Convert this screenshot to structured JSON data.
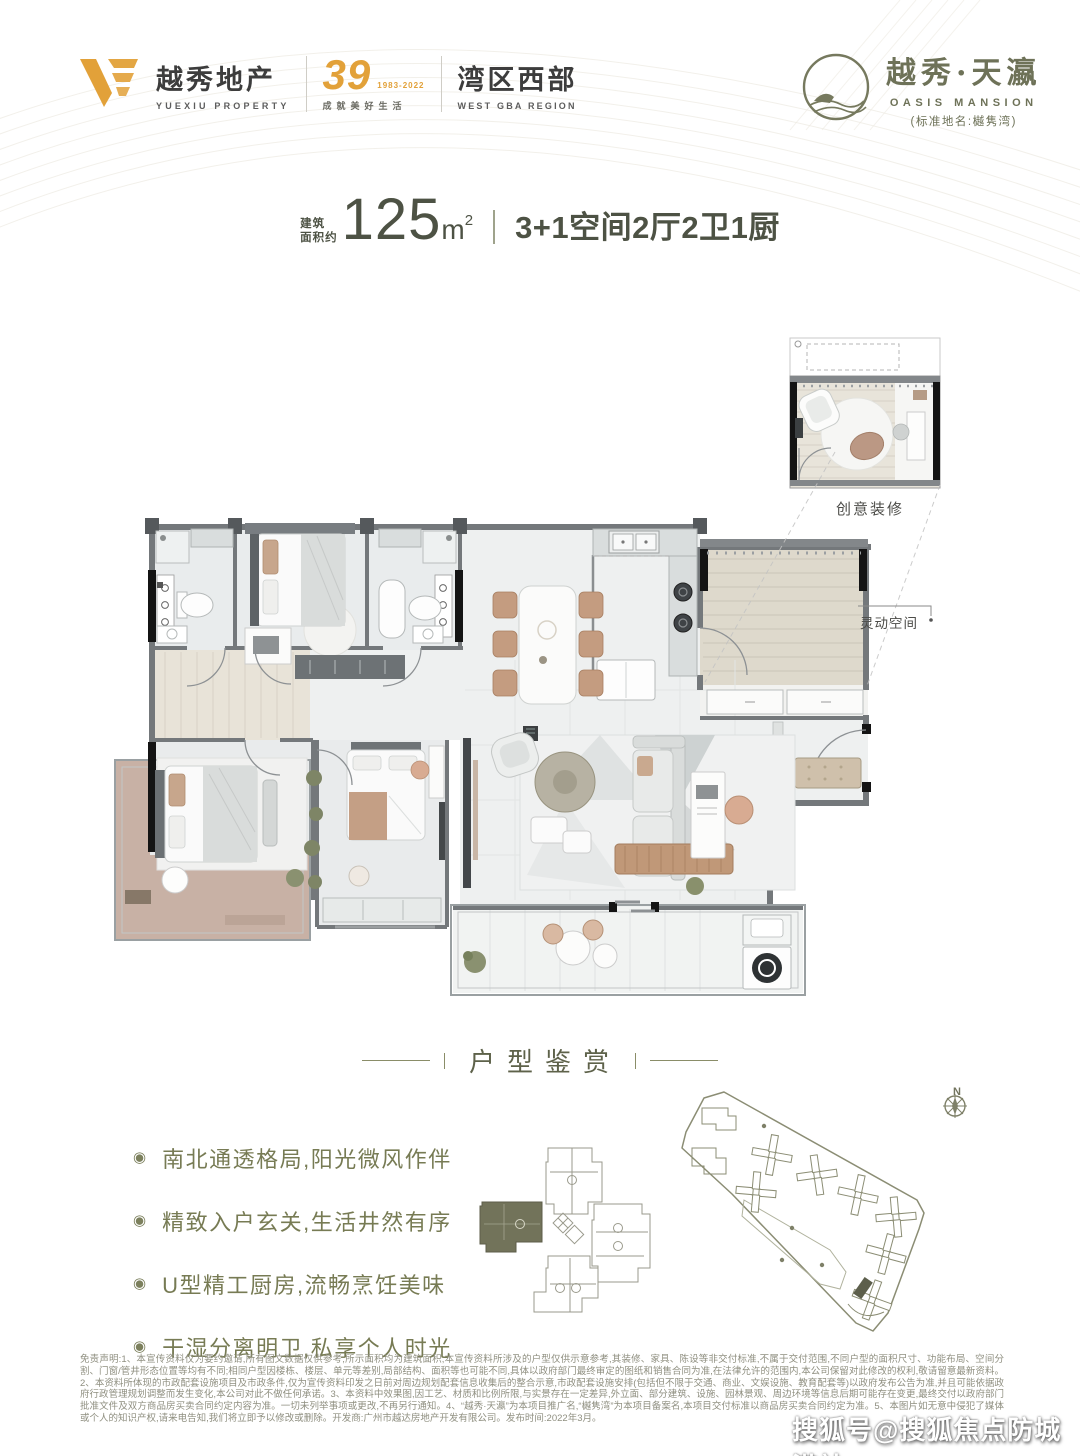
{
  "brand": {
    "yuexiu": {
      "cn": "越秀地产",
      "en": "YUEXIU PROPERTY"
    },
    "anniversary": {
      "number": "39",
      "years": "1983-2022",
      "slogan": "成就美好生活"
    },
    "region": {
      "cn": "湾区西部",
      "en": "WEST GBA REGION"
    },
    "project": {
      "cn": "越秀·天瀛",
      "en": "OASIS MANSION",
      "standard_name": "(标准地名:樾隽湾)"
    }
  },
  "headline": {
    "area_label_l1": "建筑",
    "area_label_l2": "面积约",
    "area_value": "125",
    "area_unit": "m",
    "area_sup": "2",
    "spec": "3+1空间2厅2卫1厨"
  },
  "floorplan": {
    "inset_caption": "创意装修",
    "flex_space_label": "灵动空间"
  },
  "section_title": "户型鉴赏",
  "features": [
    "南北通透格局,阳光微风作伴",
    "精致入户玄关,生活井然有序",
    "U型精工厨房,流畅烹饪美味",
    "干湿分离明卫,私享个人时光"
  ],
  "site": {
    "compass": "N"
  },
  "disclaimer": "免责声明:1、本宣传资料仅为要约邀请,所有图文数据仅供参考,所示面积均为建筑面积,本宣传资料所涉及的户型仅供示意参考,其装修、家具、陈设等非交付标准,不属于交付范围,不同户型的面积尺寸、功能布局、空间分割、门窗/管井形态位置等均有不同;相同户型因楼栋、楼层、单元等差别,局部结构、面积等也可能不同,具体以政府部门最终审定的图纸和销售合同为准,在法律允许的范围内,本公司保留对此修改的权利,敬请留意最新资料。2、本资料所体现的市政配套设施项目及市政条件,仅为宣传资料印发之日前对周边规划配套信息收集后的整合示意,市政配套设施安排(包括但不限于交通、商业、文娱设施、教育配套等)以政府发布公告为准,并且可能依据政府行政管理规划调整而发生变化,本公司对此不做任何承诺。3、本资料中效果图,因工艺、材质和比例所限,与实景存在一定差异,外立面、部分建筑、设施、园林景观、周边环境等信息后期可能存在变更,最终交付以政府部门批准文件及双方商品房买卖合同约定内容为准。一切未列举事项或更改,不再另行通知。4、“越秀·天瀛”为本项目推广名,“樾隽湾”为本项目备案名,本项目交付标准以商品房买卖合同约定为准。5、本图片如无意中侵犯了媒体或个人的知识产权,请来电告知,我们将立即予以修改或删除。开发商:广州市越达房地产开发有限公司。发布时间:2022年3月。",
  "watermark": "搜狐号@搜狐焦点防城港站",
  "colors": {
    "brand_orange": "#e2a139",
    "brand_olive": "#6e7258",
    "headline_green": "#4d5244",
    "feature_green": "#777b54",
    "wall_gray": "#74787b",
    "wood": "#ddd8cc",
    "balcony_tan": "#c8b1a5"
  }
}
